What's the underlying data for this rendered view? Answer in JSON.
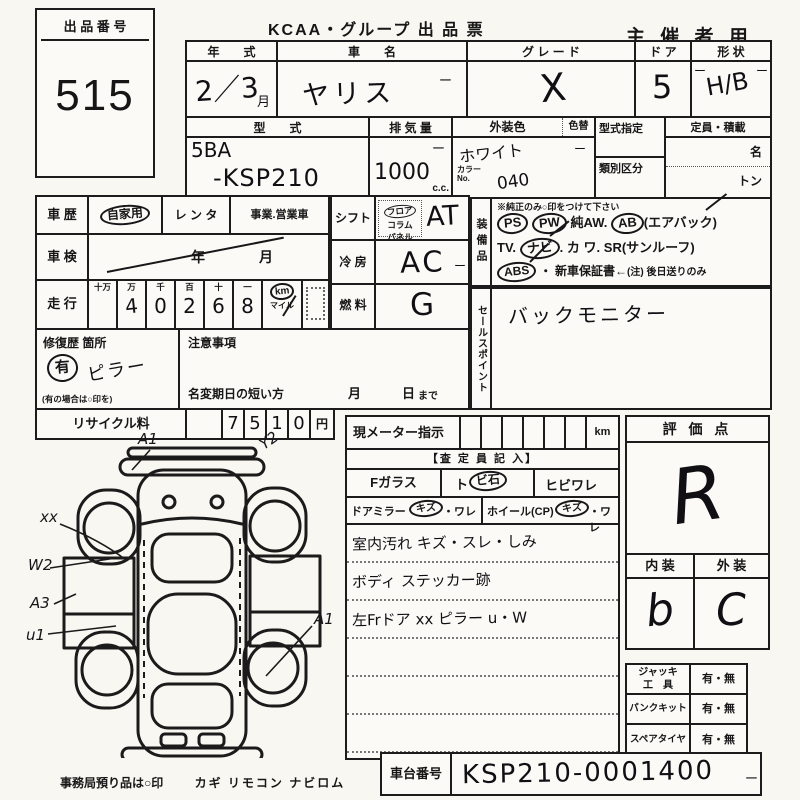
{
  "paper": {
    "lot_label": "出 品 番 号",
    "lot_number": "515",
    "title": "KCAA・グループ 出 品 票",
    "audience": "主 催 者 用",
    "tick": "ー"
  },
  "vehicle": {
    "year_label": "年　　式",
    "year_value": "2／3",
    "year_month_suffix": "月",
    "name_label": "車　　名",
    "name_value": "ヤリス",
    "grade_label": "グ レ ー ド",
    "grade_value": "X",
    "door_label": "ド ア",
    "door_value": "5",
    "shape_label": "形 状",
    "shape_value": "H/B",
    "model_label": "型　　式",
    "model_line1": "5BA",
    "model_line2": "-KSP210",
    "displacement_label": "排 気 量",
    "displacement_value": "1000",
    "displacement_unit": "c.c.",
    "ext_color_label": "外装色",
    "color_change_label": "色替",
    "ext_color_value": "ホワイト",
    "color_no_label_1": "カラー",
    "color_no_label_2": "No.",
    "color_no_value": "040",
    "type_designation_label": "型式指定",
    "class_section_label": "類別区分",
    "capacity_label": "定員・積載",
    "capacity_persons_unit": "名",
    "capacity_tons_unit": "トン"
  },
  "history": {
    "history_label": "車 歴",
    "use_private": "自家用",
    "use_rental": "レ ン タ",
    "use_business": "事業.営業車",
    "inspection_label": "車 検",
    "inspection_year_unit": "年",
    "inspection_month_unit": "月",
    "mileage_label": "走 行",
    "odo_units": [
      "十万",
      "万",
      "千",
      "百",
      "十",
      "一"
    ],
    "odo_digits": [
      "",
      "4",
      "0",
      "2",
      "6",
      "8"
    ],
    "km_label": "km",
    "mile_label": "マイル",
    "repair_label": "修復歴 箇所",
    "repair_mark": "有",
    "repair_detail": "ピラー",
    "repair_hint": "(有の場合は○印を)",
    "caution_label": "注意事項",
    "rename_label": "名変期日の短い方",
    "rename_month_unit": "月",
    "rename_day_unit": "日",
    "rename_until": "まで",
    "recycle_label": "リサイクル料",
    "recycle_digits": [
      "7",
      "5",
      "1",
      "0"
    ],
    "recycle_unit": "円"
  },
  "controls": {
    "shift_label": "シフト",
    "shift_options": [
      "フロア",
      "コラム",
      "パネル"
    ],
    "shift_value": "AT",
    "cooling_label": "冷 房",
    "cooling_value": "AC",
    "fuel_label": "燃 料",
    "fuel_value": "G"
  },
  "equipment": {
    "label_vertical": "装備品",
    "note": "※純正のみ○印をつけて下さい",
    "ps": "PS",
    "pw": "PW",
    "aw": "純AW.",
    "ab": "AB",
    "ab_suffix": "(エアバック)",
    "tv": "TV.",
    "navi": "ナビ",
    "navi_dot": ".",
    "kawa": "カ ワ.",
    "sr": "SR(サンルーフ)",
    "abs": "ABS",
    "warranty": "・ 新車保証書←",
    "warranty_note": "(注) 後日送りのみ"
  },
  "sales_point": {
    "label_vertical": "セールスポイント",
    "value": "バックモニター"
  },
  "assessment": {
    "meter_label": "現メーター指示",
    "meter_unit": "km",
    "assessor_header": "【査 定 員 記 入】",
    "front_glass_label": "Fガラス",
    "front_glass_opt1a": "ト",
    "front_glass_opt1b": "ビ石",
    "front_glass_opt2": "ヒビワレ",
    "door_mirror_label": "ドアミラー",
    "door_mirror_opt1": "キズ",
    "door_mirror_opt2": "・ワレ",
    "wheel_label": "ホイール(CP)",
    "wheel_opt1": "キズ",
    "wheel_opt2": "・ワレ",
    "notes": [
      "室内汚れ キズ・スレ・しみ",
      "ボディ ステッカー跡",
      "左Frドア xx ピラー u・W"
    ]
  },
  "grade": {
    "score_label": "評 価 点",
    "score_value": "R",
    "interior_label": "内 装",
    "interior_value": "b",
    "exterior_label": "外 装",
    "exterior_value": "C"
  },
  "accessories": {
    "rows": [
      {
        "label1": "ジャッキ",
        "label2": "工　具",
        "value": "有・無"
      },
      {
        "label1": "パンクキット",
        "label2": "",
        "value": "有・無"
      },
      {
        "label1": "スペアタイヤ",
        "label2": "",
        "value": "有・無"
      }
    ]
  },
  "footer": {
    "deposit_note": "事務局預り品は○印",
    "deposit_items": "カギ リモコン ナビロム",
    "vin_label": "車台番号",
    "vin_value": "KSP210-0001400"
  },
  "diagram": {
    "ann_front": "A1",
    "ann_front_right": "Y2",
    "ann_xx": "xx",
    "ann_w2": "W2",
    "ann_a3": "A3",
    "ann_u1": "u1",
    "ann_rear_right": "A1"
  }
}
